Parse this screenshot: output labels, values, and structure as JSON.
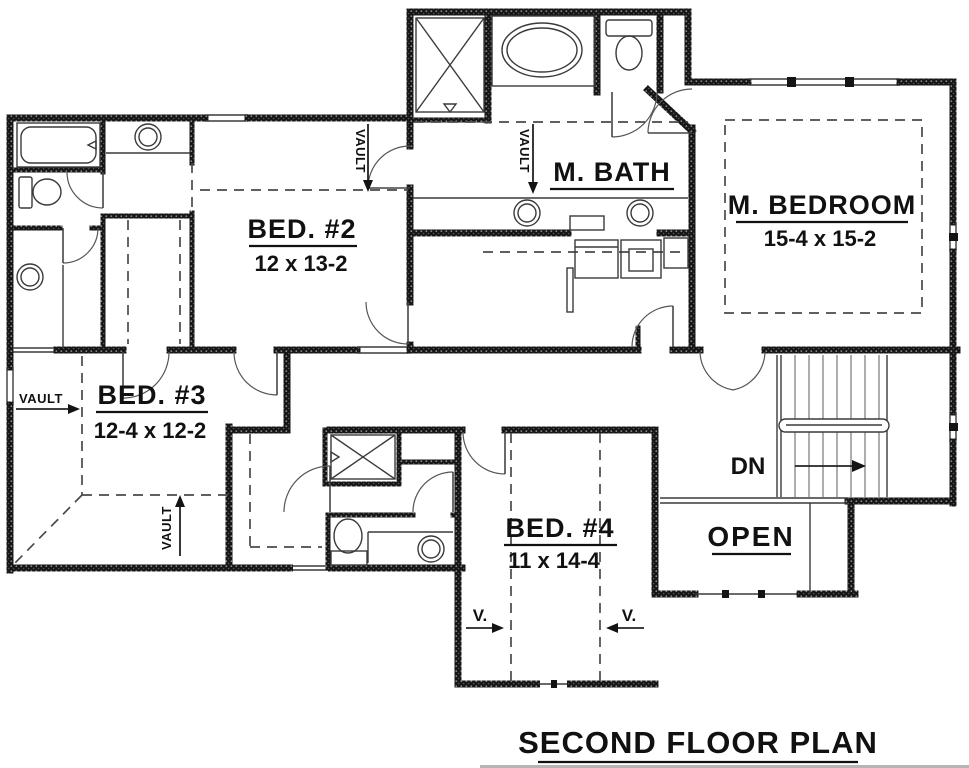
{
  "title": {
    "text": "SECOND FLOOR PLAN"
  },
  "rooms": {
    "bed2": {
      "name": "BED. #2",
      "dims": "12 x 13-2"
    },
    "bed3": {
      "name": "BED. #3",
      "dims": "12-4 x 12-2"
    },
    "bed4": {
      "name": "BED. #4",
      "dims": "11 x 14-4"
    },
    "master_bedroom": {
      "name": "M. BEDROOM",
      "dims": "15-4 x 15-2"
    },
    "master_bath": {
      "name": "M. BATH"
    }
  },
  "annotations": {
    "vault": "VAULT",
    "vault_short": "V.",
    "down": "DN",
    "open": "OPEN"
  },
  "colors": {
    "ink": "#141414",
    "background": "#ffffff"
  }
}
